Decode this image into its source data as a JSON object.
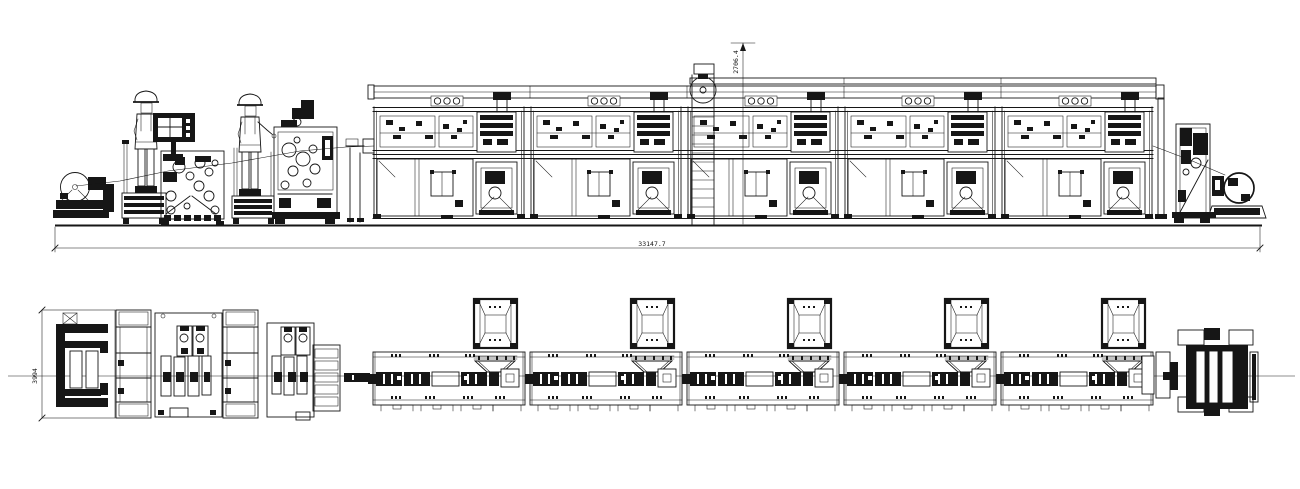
{
  "canvas": {
    "background": "#ffffff",
    "ink": "#161616",
    "centerline_color": "#8f8f8f",
    "hatch_color": "#5a5a5a"
  },
  "dimensions": {
    "overall_length": "33147.7",
    "overall_height": "2706.4",
    "plan_width": "3994"
  },
  "modules": {
    "count": 5,
    "first_left": 373,
    "pitch": 157,
    "width": 152
  }
}
